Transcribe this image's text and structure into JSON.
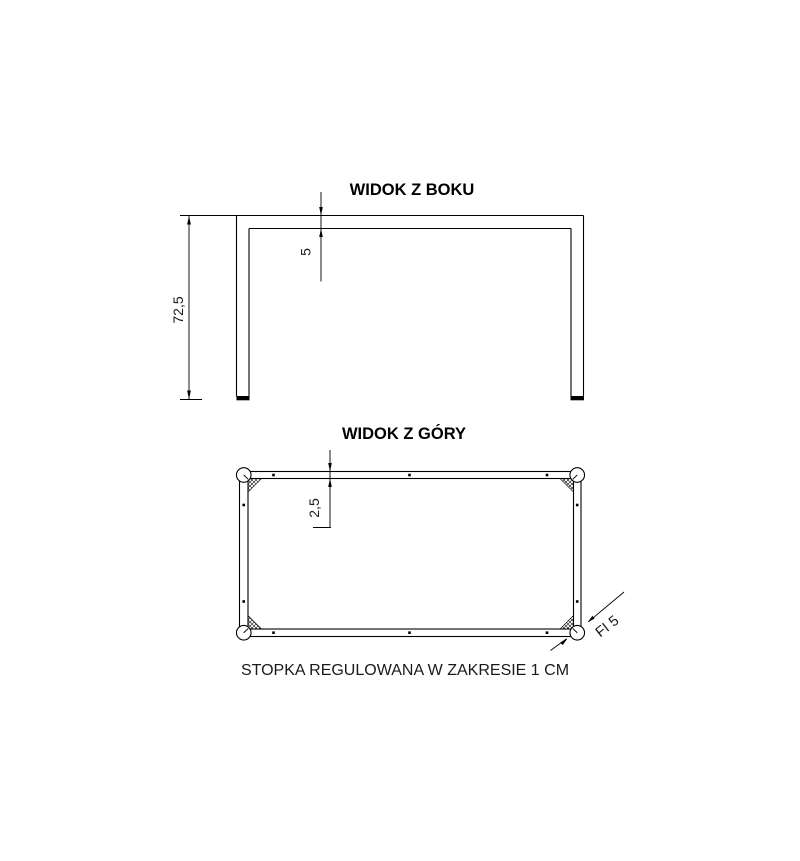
{
  "drawing": {
    "type": "technical-drawing-table-frame",
    "colors": {
      "line": "#000000",
      "background": "#ffffff",
      "foot_pad": "#000000"
    },
    "side_view": {
      "title": "WIDOK Z BOKU",
      "height_dim": "72,5",
      "beam_thickness_dim": "5"
    },
    "top_view": {
      "title": "WIDOK Z GÓRY",
      "frame_thickness_dim": "2,5",
      "foot_diameter_dim": "FI 5"
    },
    "footer_note": "STOPKA REGULOWANA W ZAKRESIE 1 CM"
  }
}
